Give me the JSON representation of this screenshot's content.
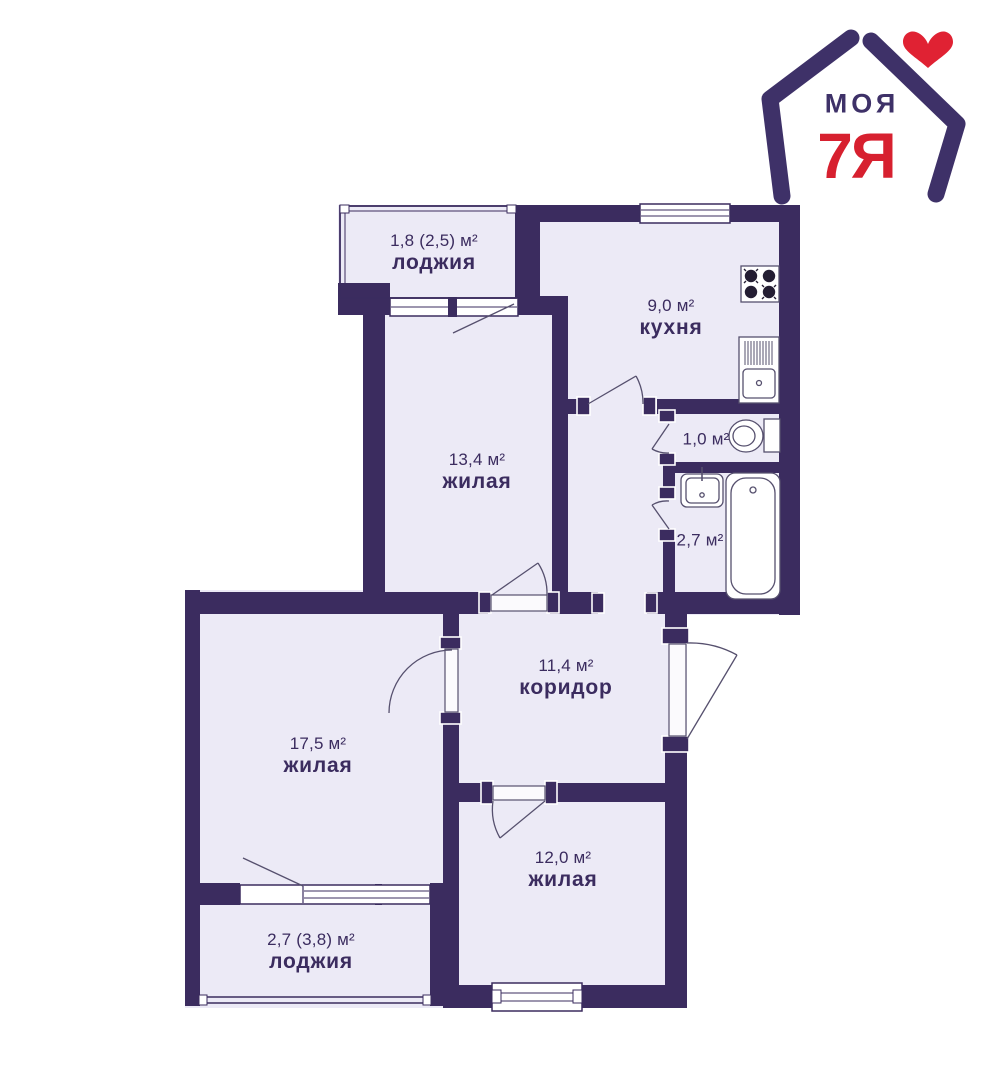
{
  "palette": {
    "wall": "#3B2C5F",
    "room_fill": "#ECEAF6",
    "fixture_stroke": "#56506E",
    "logo_purple": "#3E3168",
    "logo_red": "#D7202F",
    "heart_red": "#E02233",
    "label_text": "#3B2C5F",
    "background": "#FFFFFF"
  },
  "logo": {
    "line1": "МОЯ",
    "line2": "7Я",
    "icons": [
      "house-icon",
      "heart-icon"
    ]
  },
  "rooms": [
    {
      "id": "loggia-top",
      "area": "1,8 (2,5) м²",
      "name": "лоджия"
    },
    {
      "id": "kitchen",
      "area": "9,0 м²",
      "name": "кухня"
    },
    {
      "id": "living-13",
      "area": "13,4 м²",
      "name": "жилая"
    },
    {
      "id": "wc",
      "area": "1,0 м²",
      "name": ""
    },
    {
      "id": "bathroom",
      "area": "2,7 м²",
      "name": ""
    },
    {
      "id": "corridor",
      "area": "11,4 м²",
      "name": "коридор"
    },
    {
      "id": "living-17",
      "area": "17,5 м²",
      "name": "жилая"
    },
    {
      "id": "living-12",
      "area": "12,0 м²",
      "name": "жилая"
    },
    {
      "id": "loggia-bottom",
      "area": "2,7 (3,8) м²",
      "name": "лоджия"
    }
  ],
  "fixtures": [
    {
      "icon": "stove-icon"
    },
    {
      "icon": "kitchen-sink-icon"
    },
    {
      "icon": "toilet-icon"
    },
    {
      "icon": "washbasin-icon"
    },
    {
      "icon": "bathtub-icon"
    }
  ]
}
